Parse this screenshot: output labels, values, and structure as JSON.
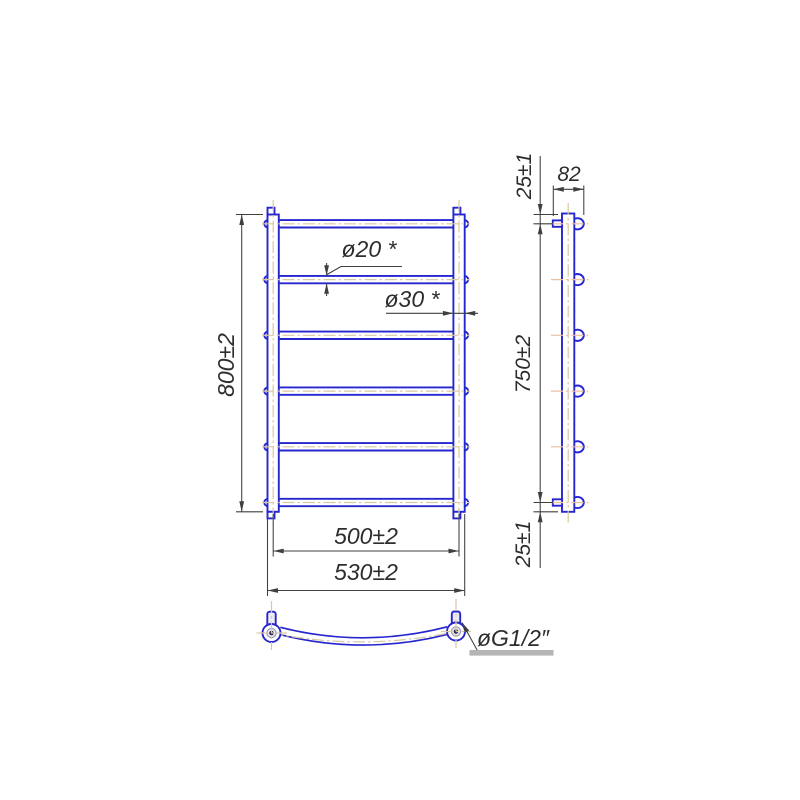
{
  "drawing": {
    "title": "ladder towel rail technical drawing, three views",
    "front_view": {
      "height_label": "800±2",
      "inner_width_label": "500±2",
      "overall_width_label": "530±2",
      "rung_diameter_label": "ø20 *",
      "post_diameter_label": "ø30 *",
      "rungs_count": 6
    },
    "side_view": {
      "depth_label": "82",
      "top_offset_label": "25±1",
      "mount_span_label": "750±2",
      "bottom_offset_label": "25±1"
    },
    "bottom_view": {
      "thread_label": "øG1/2″"
    },
    "colors": {
      "outline": "#2626cf",
      "centerline": "#d9c9a2",
      "centerline_warm": "#eebfa0",
      "dimension": "#3f3f3f",
      "text": "#2d2d2d",
      "shelf_bar": "#b5b5b5"
    }
  }
}
